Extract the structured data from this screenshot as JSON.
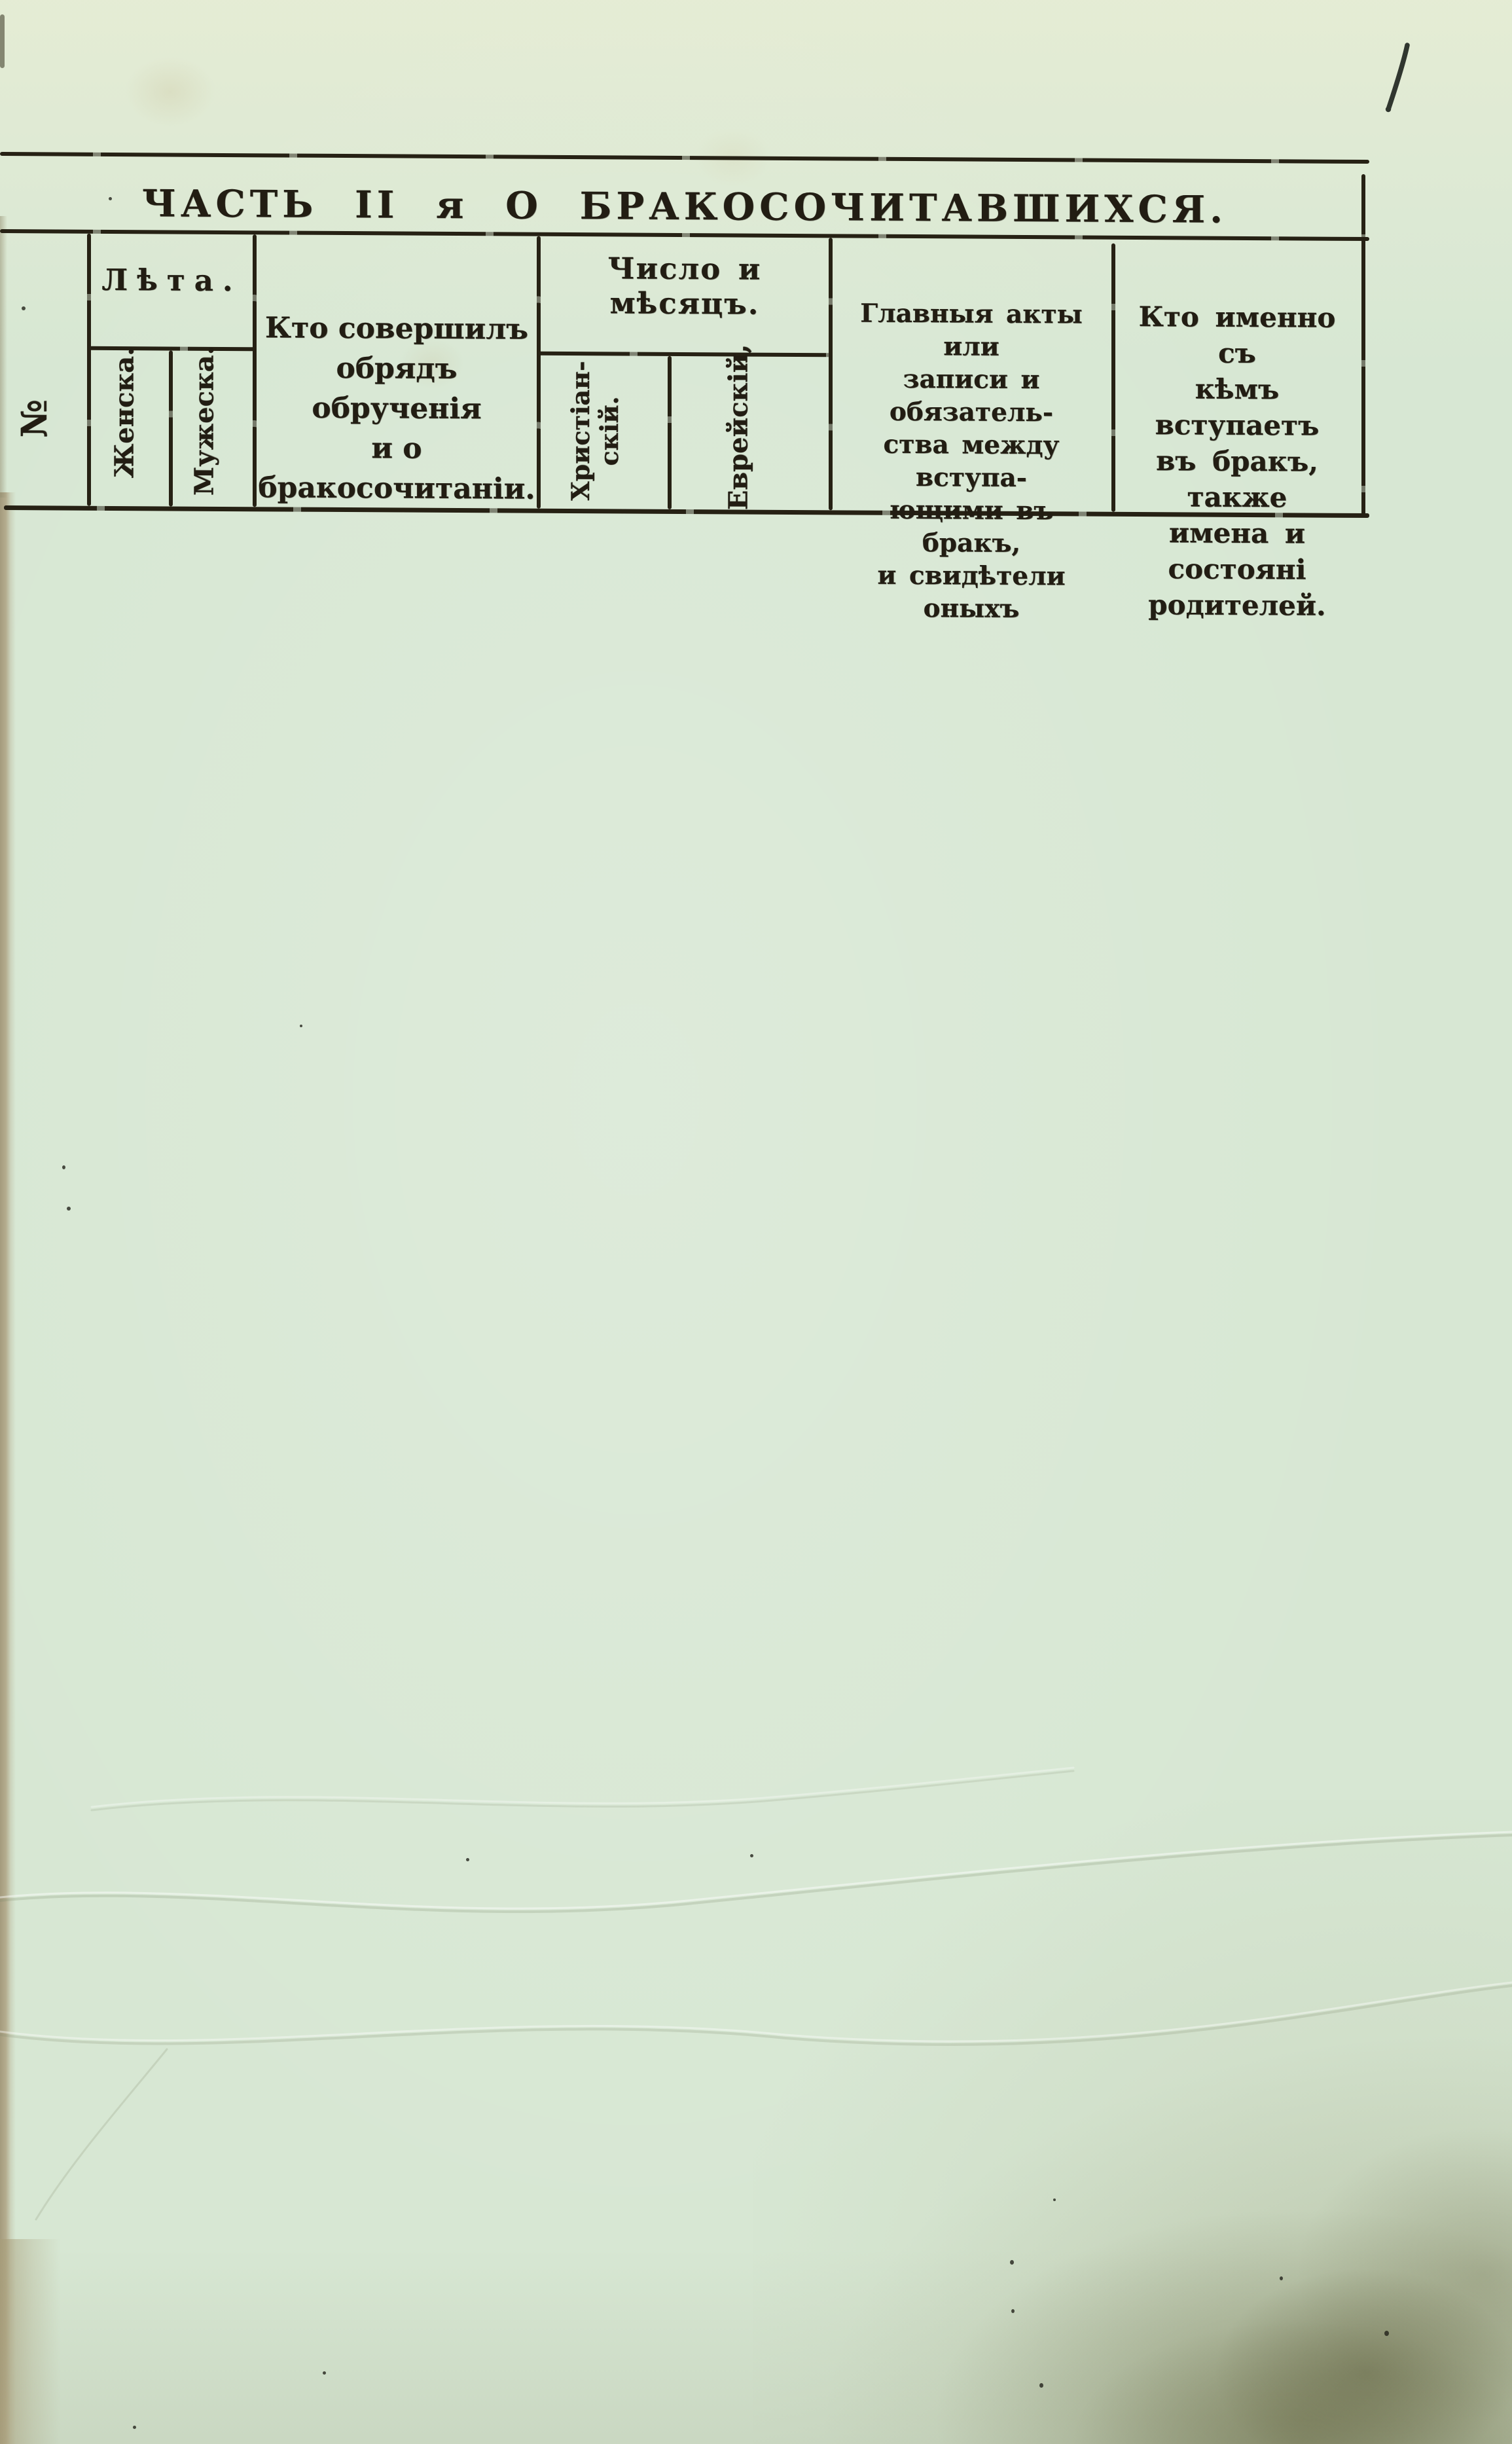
{
  "page": {
    "handwritten_number": "1",
    "colors": {
      "paper": "#d7e7d3",
      "ink": "#221d13",
      "rule": "#262114",
      "page_edge_tan": "#b2aa8b",
      "stain_olive": "#8c8c64"
    }
  },
  "table": {
    "title": "ЧАСТЬ II я О БРАКОСОЧИТАВШИХСЯ.",
    "columns": {
      "number": {
        "label": "№"
      },
      "age": {
        "label": "Лѣта.",
        "female": "Женска.",
        "male": "Мужеска."
      },
      "officiant": {
        "lines": [
          "Кто совершилъ",
          "обрядъ обрученія",
          "и о бракосочитаніи."
        ]
      },
      "date": {
        "label": "Число и мѣсяцъ.",
        "christian_lines": [
          "Христіан-",
          "скій."
        ],
        "jewish": "Еврейскій,"
      },
      "acts": {
        "lines": [
          "Главныя акты или",
          "записи и обязатель-",
          "ства между вступа-",
          "ющими въ бракъ,",
          "и свидѣтели оныхъ"
        ]
      },
      "spouses": {
        "lines": [
          "Кто именно съ",
          "кѣмъ вступаетъ",
          "въ бракъ, также",
          "имена и состояні",
          "родителей."
        ]
      }
    }
  }
}
